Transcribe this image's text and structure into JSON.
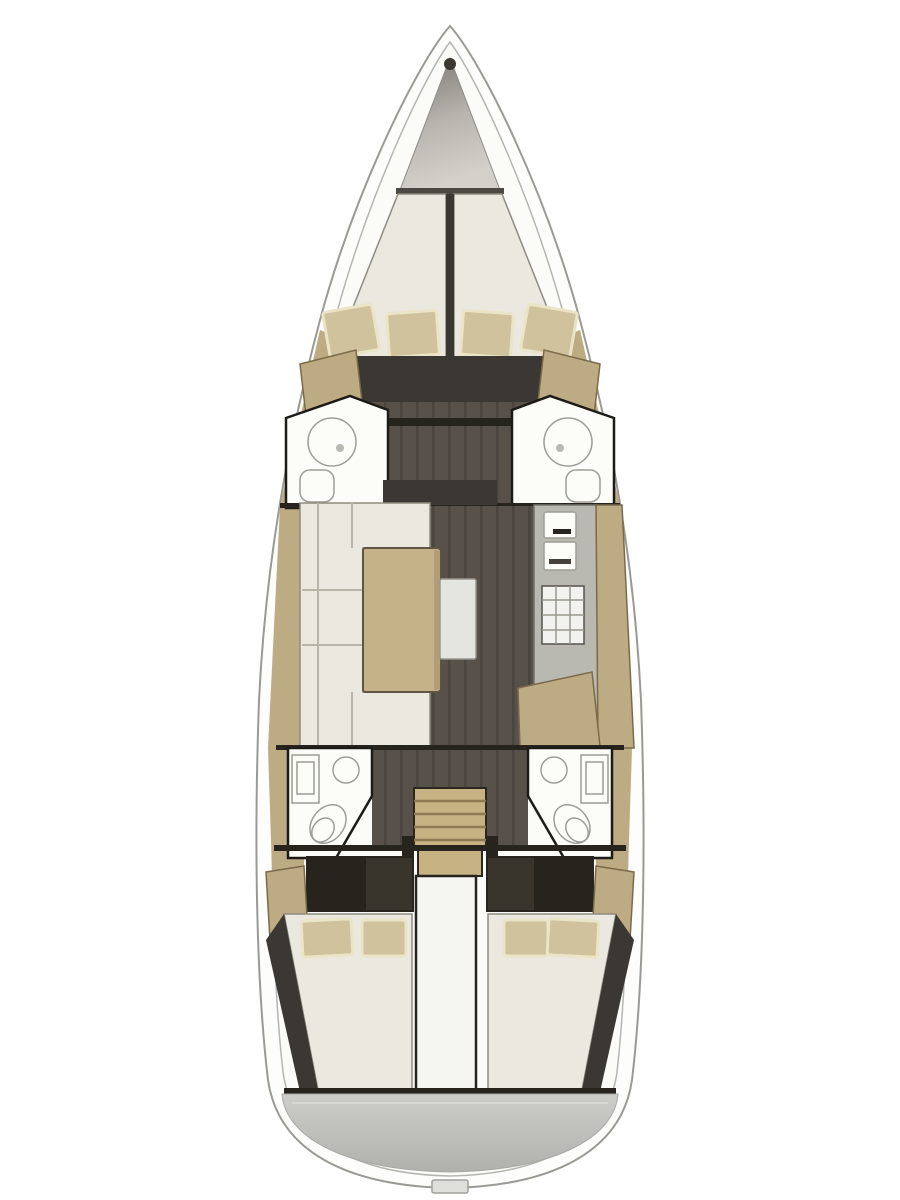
{
  "figure": {
    "kind": "sailing-yacht-interior-floorplan",
    "orientation": "bow-up",
    "visible_text": ""
  },
  "colors": {
    "page_bg": "#ffffff",
    "hull_fill": "#fdfdfc",
    "hull_line": "#9a9a95",
    "hull_inner_line": "#b5b5b0",
    "interior_bg": "#fbfbf8",
    "berth": "#eae8df",
    "cushion": "#cfc29c",
    "cushion_edge": "#ece4c6",
    "wood": "#bdab83",
    "wood_edge": "#7a6a4a",
    "wood_table": "#c6b289",
    "wood_step": "#c7b283",
    "floor": "#57514a",
    "floor_deep": "#3b3732",
    "wall": "#26241d",
    "fixture": "#fcfcf9",
    "fixture_line": "#9d9d96",
    "galley": "#b9b9b2",
    "bench_white": "#e5e5df",
    "transom": "#b5b5b1",
    "transom_light": "#cdcdc9",
    "anchor_dark": "#78766f",
    "anchor_light": "#d3d1ca"
  }
}
